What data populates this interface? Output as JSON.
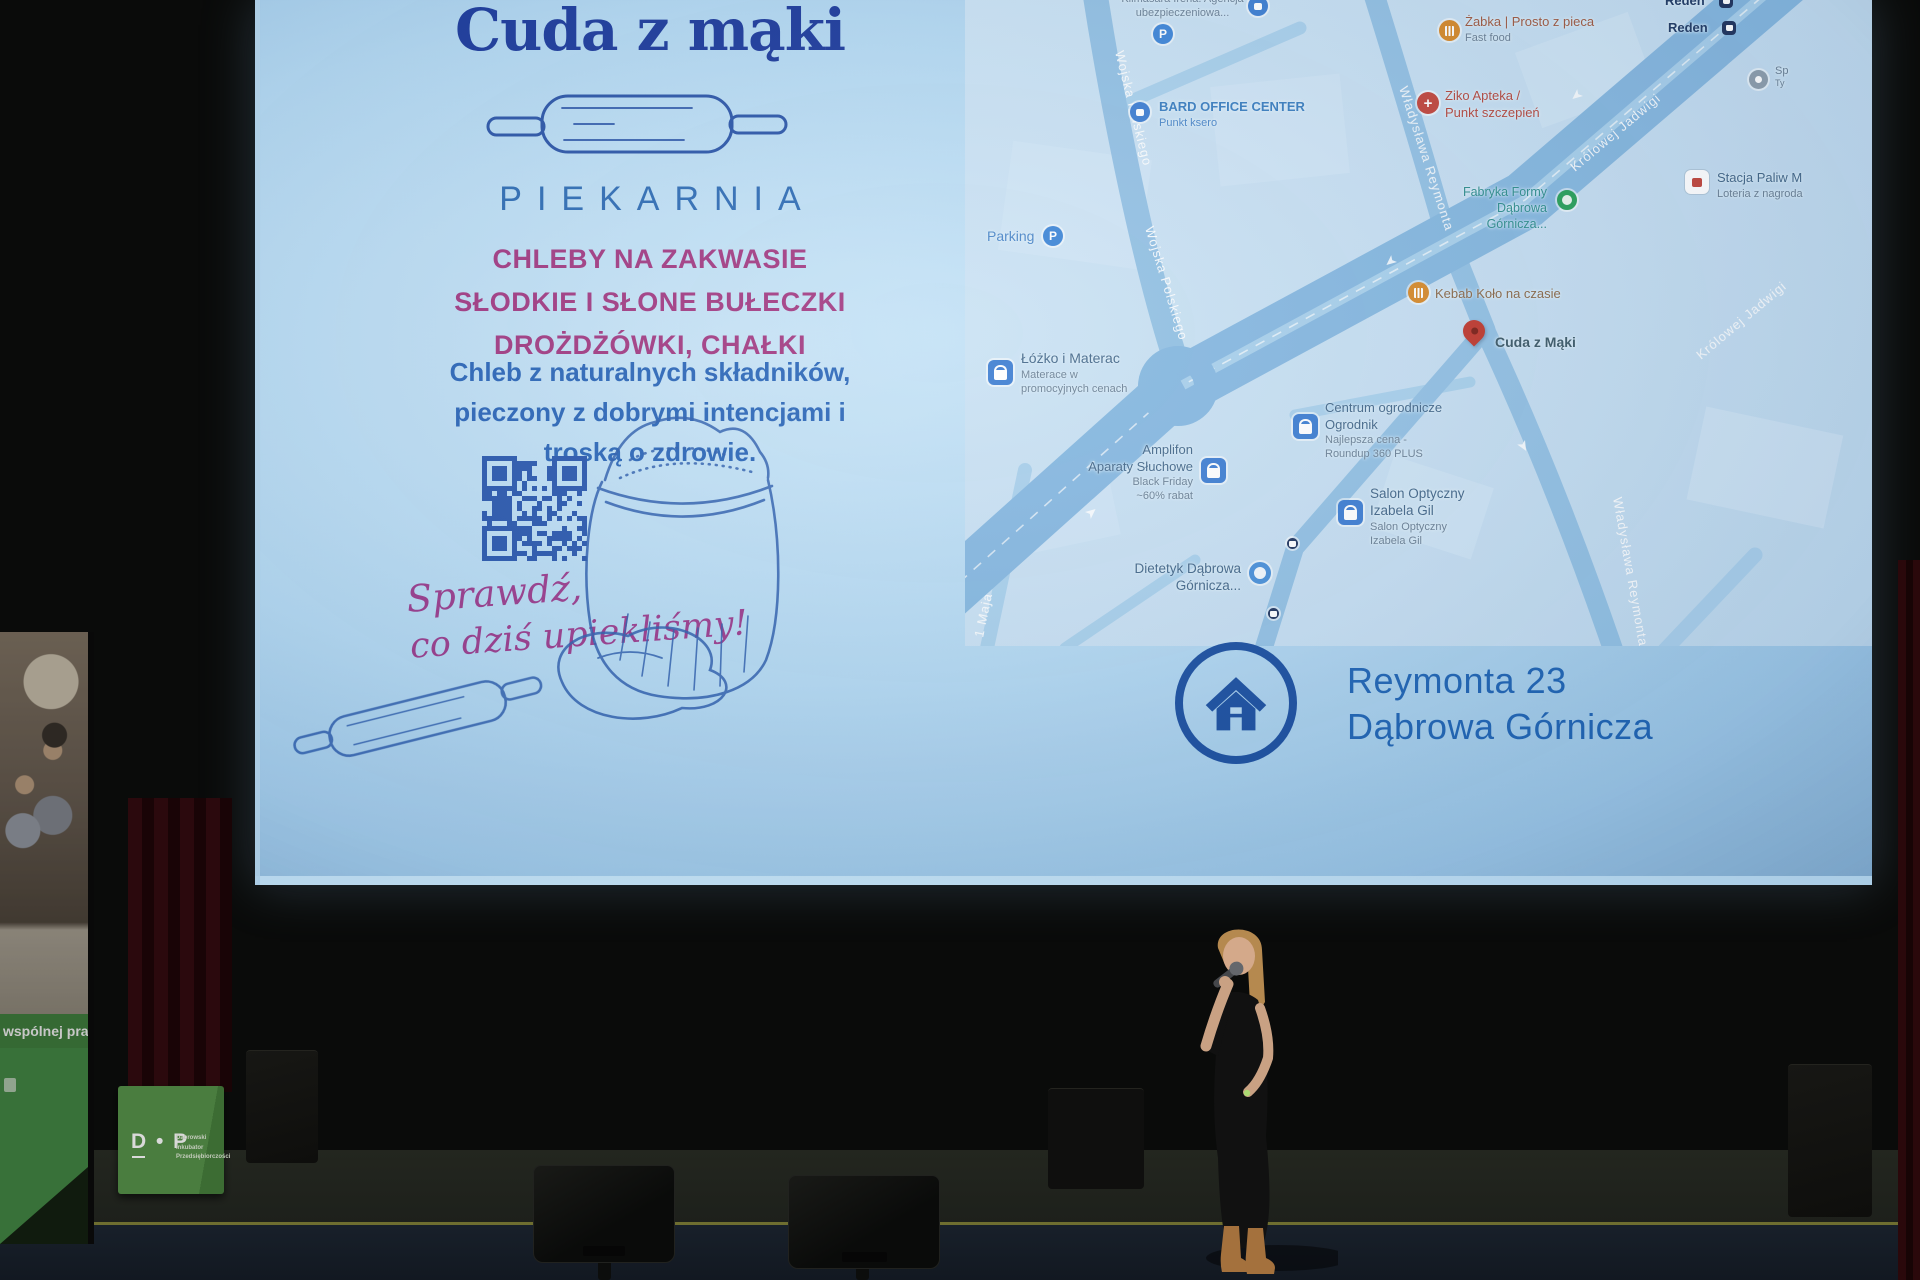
{
  "slide": {
    "title": "Cuda z mąki",
    "subtitle": "PIEKARNIA",
    "offer": [
      "CHLEBY NA ZAKWASIE",
      "SŁODKIE I SŁONE BUŁECZKI",
      "DROŻDŻÓWKI, CHAŁKI"
    ],
    "description": [
      "Chleb z naturalnych składników,",
      "pieczony z dobrymi intencjami i",
      "troską o zdrowie."
    ],
    "handwritten": [
      "Sprawdź,",
      "co dziś upiekliśmy!"
    ],
    "address": [
      "Reymonta 23",
      "Dąbrowa Górnicza"
    ],
    "colors": {
      "title": "#1c3a9c",
      "accent_pink": "#a23a82",
      "text_blue": "#2b66b8",
      "script_purple": "#9b3d8d",
      "address_blue": "#1f64b4",
      "qr_blue": "#2a58ae",
      "sketch_blue": "#2f5fae"
    }
  },
  "map": {
    "streets": {
      "wojska": "Wojska Polskiego",
      "reymonta": "Władysława Reymonta",
      "jadwigi": "Królowej Jadwigi",
      "maja": "1 Maja"
    },
    "pois": {
      "klimasara": {
        "l1": "Klimasara Irena. Agencja",
        "l2": "ubezpieczeniowa..."
      },
      "bard": {
        "l1": "BARD OFFICE CENTER",
        "l2": "Punkt ksero"
      },
      "parking": {
        "l1": "Parking"
      },
      "zabka": {
        "l1": "Żabka | Prosto z pieca",
        "l2": "Fast food"
      },
      "reden": {
        "l1": "Reden"
      },
      "ziko": {
        "l1": "Ziko Apteka /",
        "l2": "Punkt szczepień"
      },
      "sp": {
        "l1": "Sp",
        "l2": "Ty"
      },
      "stacja": {
        "l1": "Stacja Paliw M",
        "l2": "Loteria z nagroda"
      },
      "fabryka": {
        "l1": "Fabryka Formy",
        "l2": "Dąbrowa Górnicza..."
      },
      "kebab": {
        "l1": "Kebab Koło na czasie"
      },
      "cuda": {
        "l1": "Cuda z Mąki"
      },
      "lozko": {
        "l1": "Łóżko i Materac",
        "l2": "Materace w",
        "l3": "promocyjnych cenach"
      },
      "amplifon": {
        "l1": "Amplifon",
        "l2": "Aparaty Słuchowe",
        "l3": "Black Friday",
        "l4": "~60% rabat"
      },
      "centrum": {
        "l1": "Centrum ogrodnicze",
        "l2": "Ogrodnik",
        "l3": "Najlepsza cena -",
        "l4": "Roundup 360 PLUS"
      },
      "salon": {
        "l1": "Salon Optyczny",
        "l2": "Izabela Gil",
        "l3": "Salon Optyczny",
        "l4": "Izabela Gil"
      },
      "dietetyk": {
        "l1": "Dietetyk Dąbrowa",
        "l2": "Górnicza..."
      }
    }
  },
  "banner": {
    "caption": "wspólnej pracy"
  },
  "cube": {
    "logo": "D • P",
    "org": [
      "Dąbrowski",
      "Inkubator",
      "Przedsiębiorczości"
    ]
  }
}
